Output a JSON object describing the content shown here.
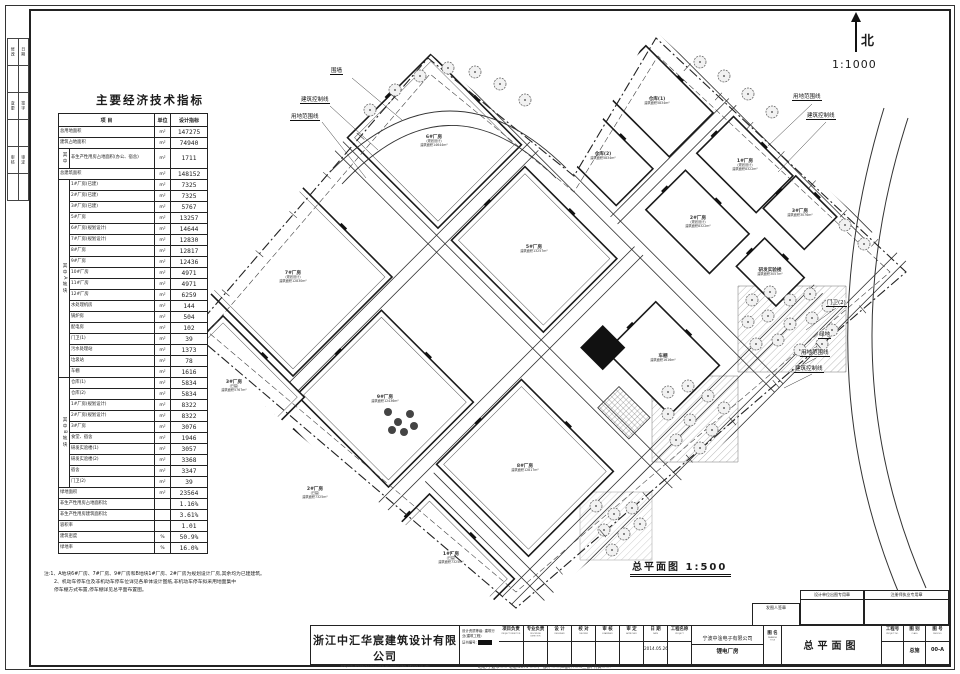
{
  "colors": {
    "paper": "#ffffff",
    "ink": "#1c1c1c",
    "road": "#333333",
    "tree": "#666666",
    "hatch": "#9a9a9a"
  },
  "sheet": {
    "margin_rows": [
      [
        "修改",
        "日期"
      ],
      [
        "",
        ""
      ],
      [
        "变更",
        "签字"
      ],
      [
        "",
        ""
      ],
      [
        "审核",
        "审定"
      ],
      [
        "",
        ""
      ]
    ],
    "footer_note": "地址:宁波市……  电话:0574-……(一部); ……(二部); ……(三部)  传真:……"
  },
  "compass": {
    "label": "北",
    "scale": "1:1000"
  },
  "plan": {
    "labels": {
      "fence": "围墙",
      "control": "建筑控制线",
      "red": "用地范围线",
      "green": "绿地",
      "gate": "门卫(2)",
      "caption": "总平面图  1:500"
    },
    "buildings": [
      {
        "label": "6#厂房",
        "sub": "(规划设计)",
        "area": "建筑面积14644m²"
      },
      {
        "label": "5#厂房",
        "sub": "",
        "area": "建筑面积13257m²"
      },
      {
        "label": "7#厂房",
        "sub": "(规划设计)",
        "area": "建筑面积12830m²"
      },
      {
        "label": "9#厂房",
        "sub": "",
        "area": "建筑面积12436m²"
      },
      {
        "label": "8#厂房",
        "sub": "",
        "area": "建筑面积12817m²"
      },
      {
        "label": "3#厂房",
        "sub": "(已建)",
        "area": "建筑面积5767m²"
      },
      {
        "label": "2#厂房",
        "sub": "(已建)",
        "area": "建筑面积7325m²"
      },
      {
        "label": "1#厂房",
        "sub": "(已建)",
        "area": "建筑面积7325m²"
      },
      {
        "label": "车棚",
        "sub": "",
        "area": "建筑面积1616m²"
      },
      {
        "label": "仓库(1)",
        "sub": "",
        "area": "建筑面积5834m²"
      },
      {
        "label": "仓库(2)",
        "sub": "",
        "area": "建筑面积5834m²"
      },
      {
        "label": "1#厂房",
        "sub": "(规划设计)",
        "area": "建筑面积8322m²"
      },
      {
        "label": "2#厂房",
        "sub": "(规划设计)",
        "area": "建筑面积8322m²"
      },
      {
        "label": "3#厂房",
        "sub": "",
        "area": "建筑面积3076m²"
      },
      {
        "label": "研发实验楼",
        "sub": "",
        "area": "建筑面积3057m²"
      }
    ]
  },
  "indicators": {
    "title": "主要经济技术指标",
    "headers": [
      "项  目",
      "单位",
      "设计指标"
    ],
    "sections": [
      {
        "group": "",
        "rows": [
          [
            "总用地面积",
            "m²",
            "147275"
          ],
          [
            "建筑占地面积",
            "m²",
            "74940"
          ]
        ]
      },
      {
        "group": "其中",
        "rows": [
          [
            "非生产性用房占地面积(办公、宿舍)",
            "m²",
            "1711"
          ]
        ]
      },
      {
        "group": "",
        "rows": [
          [
            "总建筑面积",
            "m²",
            "148152"
          ]
        ]
      },
      {
        "group": "其中A地块",
        "rows": [
          [
            "1#厂房(已建)",
            "m²",
            "7325"
          ],
          [
            "2#厂房(已建)",
            "m²",
            "7325"
          ],
          [
            "3#厂房(已建)",
            "m²",
            "5767"
          ],
          [
            "5#厂房",
            "m²",
            "13257"
          ],
          [
            "6#厂房(规划设计)",
            "m²",
            "14644"
          ],
          [
            "7#厂房(规划设计)",
            "m²",
            "12830"
          ],
          [
            "8#厂房",
            "m²",
            "12817"
          ],
          [
            "9#厂房",
            "m²",
            "12436"
          ],
          [
            "10#厂房",
            "m²",
            "4971"
          ],
          [
            "11#厂房",
            "m²",
            "4971"
          ],
          [
            "12#厂房",
            "m²",
            "6259"
          ],
          [
            "水处理机房",
            "m²",
            "144"
          ],
          [
            "锅炉房",
            "m²",
            "504"
          ],
          [
            "配电房",
            "m²",
            "102"
          ],
          [
            "门卫(1)",
            "m²",
            "39"
          ],
          [
            "污水处理站",
            "m²",
            "1373"
          ],
          [
            "垃圾站",
            "m²",
            "78"
          ],
          [
            "车棚",
            "m²",
            "1616"
          ]
        ]
      },
      {
        "group": "其中B地块",
        "rows": [
          [
            "仓库(1)",
            "m²",
            "5834"
          ],
          [
            "仓库(2)",
            "m²",
            "5834"
          ],
          [
            "1#厂房(规划设计)",
            "m²",
            "8322"
          ],
          [
            "2#厂房(规划设计)",
            "m²",
            "8322"
          ],
          [
            "3#厂房",
            "m²",
            "3076"
          ],
          [
            "食堂、宿舍",
            "m²",
            "1946"
          ],
          [
            "研发实验楼(1)",
            "m²",
            "3057"
          ],
          [
            "研发实验楼(2)",
            "m²",
            "3368"
          ],
          [
            "宿舍",
            "m²",
            "3347"
          ],
          [
            "门卫(2)",
            "m²",
            "39"
          ]
        ]
      },
      {
        "group": "",
        "rows": [
          [
            "绿地面积",
            "m²",
            "23564"
          ],
          [
            "非生产性用房占地面积比",
            "",
            "1.16%"
          ],
          [
            "非生产性用房建筑面积比",
            "",
            "3.61%"
          ],
          [
            "容积率",
            "",
            "1.01"
          ],
          [
            "建筑密度",
            "%",
            "50.9%"
          ],
          [
            "绿地率",
            "%",
            "16.0%"
          ]
        ]
      }
    ],
    "notes": [
      "注:1、A地块6#厂房、7#厂房、9#厂房和B地块1#厂房、2#厂房为规划设计厂房,其余均为已建建筑。",
      "2、机动车停车位及非机动车停车位详见各单体设计图纸,非机动车停车拟采用地面集中",
      "停车棚方式布置,停车棚详见总平面布置图。"
    ]
  },
  "titleblock": {
    "company": {
      "cn": "浙江中汇华宸建筑设计有限公司",
      "en": "ZHEJIANG ZHONGHUI HUACHEN ARCHITECTURAL DESIGN CO.,LTD"
    },
    "credentials": {
      "grade_label": "设计资质等级:",
      "grade_value": "建筑行业(建筑工程)",
      "cert_label": "证书编号:"
    },
    "sig_cols": [
      {
        "cn": "项目负责",
        "en": "PROJECT DIRECTOR",
        "value": ""
      },
      {
        "cn": "专业负责",
        "en": "DISCIPLINE DIRECTOR",
        "value": ""
      },
      {
        "cn": "设  计",
        "en": "DESIGNED",
        "value": ""
      },
      {
        "cn": "校  对",
        "en": "CHECKED",
        "value": ""
      },
      {
        "cn": "审  核",
        "en": "EXAMINED",
        "value": ""
      },
      {
        "cn": "审  定",
        "en": "APPROVED",
        "value": ""
      },
      {
        "cn": "日  期",
        "en": "DATE",
        "value": "2014.05.26"
      },
      {
        "cn": "工程名称",
        "en": "PROJECT",
        "value": ""
      }
    ],
    "project": {
      "line1": "宁波中淦电子有限公司",
      "line2": "锂电厂房"
    },
    "drawing": {
      "name_label": "图  名",
      "name_en": "DRAWING TITLE",
      "name_value": "总平面图"
    },
    "numbers": {
      "proj_no_label": "工程号",
      "proj_no_en": "PROJECT NO.",
      "proj_no_value": "",
      "class_label": "图  别",
      "class_en": "CLASS",
      "class_value": "总施",
      "dwg_label": "图  号",
      "dwg_en": "DWG NO.",
      "dwg_value": "00-A"
    },
    "stamps": [
      "发图人签章",
      "设计单位出图专用章",
      "注册师执业专用章"
    ]
  }
}
